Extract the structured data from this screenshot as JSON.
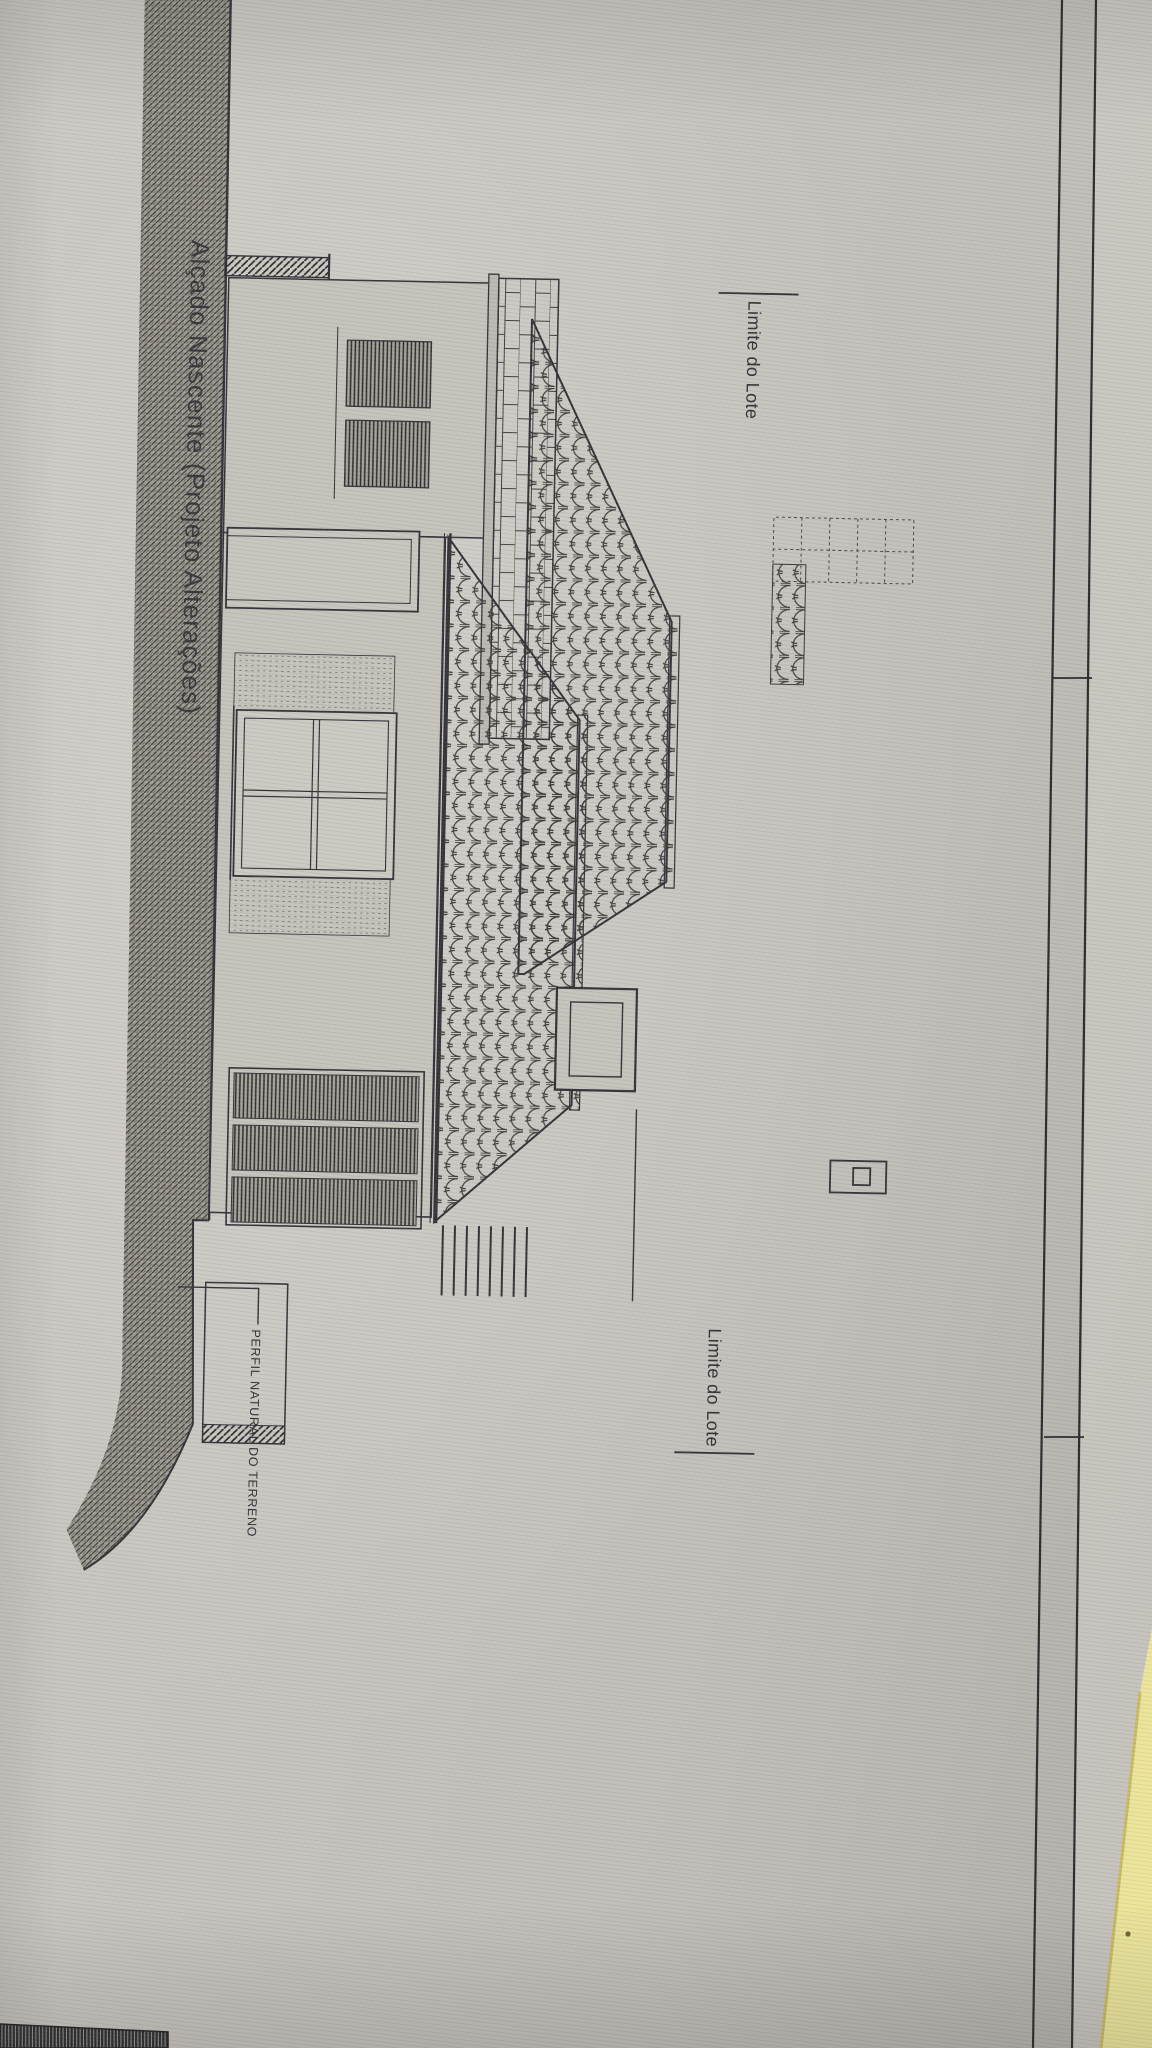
{
  "sheet": {
    "title": "Alçado Nascente (Projeto Alterações)",
    "annotations": {
      "lot_limit_top": "Limite do Lote",
      "lot_limit_bottom": "Limite do Lote",
      "terrain_profile": "PERFIL NATURAL DO TERRENO"
    },
    "colors": {
      "paper": "#c7c3be",
      "ink": "#34343a",
      "terrain_hatch": "#403f3a",
      "sticky_yellow": "#ebe49b"
    }
  }
}
